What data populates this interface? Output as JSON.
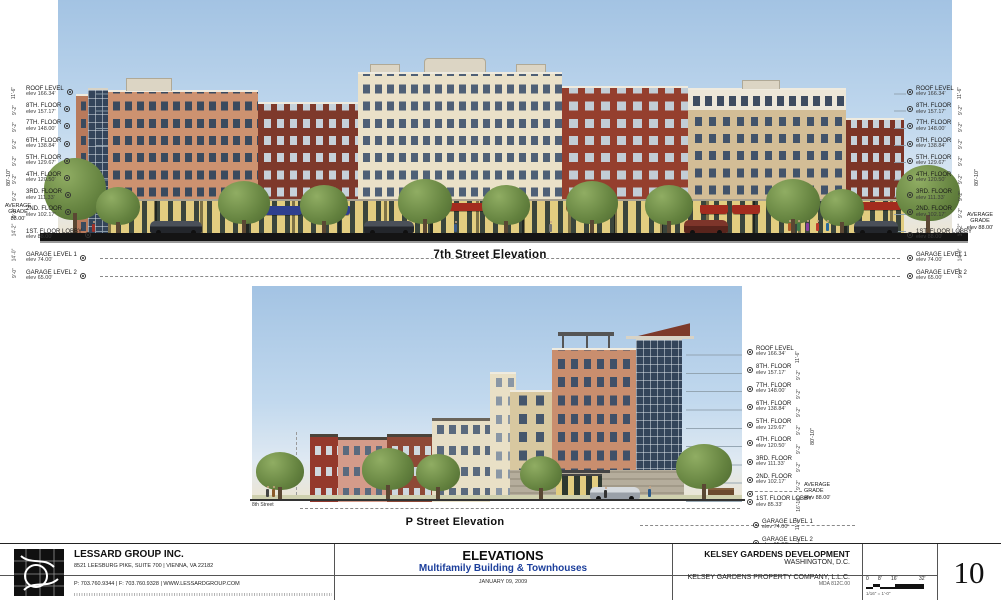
{
  "colors": {
    "subtitle_blue": "#1b3e9b",
    "awning_blue": "#2e3f8f",
    "awning_red": "#a32c1e",
    "sky_top": "#a3c3e3"
  },
  "elevation_7th": {
    "title": "7th Street  Elevation",
    "floors": [
      {
        "name": "ROOF LEVEL",
        "elev": "elev 166.34'"
      },
      {
        "name": "8TH. FLOOR",
        "elev": "elev 157.17'"
      },
      {
        "name": "7TH. FLOOR",
        "elev": "elev 148.00'"
      },
      {
        "name": "6TH. FLOOR",
        "elev": "elev 138.84'"
      },
      {
        "name": "5TH. FLOOR",
        "elev": "elev 129.67'"
      },
      {
        "name": "4TH. FLOOR",
        "elev": "elev 120.50'"
      },
      {
        "name": "3RD. FLOOR",
        "elev": "elev 111.33'"
      },
      {
        "name": "2ND. FLOOR",
        "elev": "elev 102.17'"
      },
      {
        "name": "1ST. FLOOR LOBBY",
        "elev": "elev 88.00'"
      }
    ],
    "garage_levels": [
      {
        "name": "GARAGE LEVEL 1",
        "elev": "elev 74.00'"
      },
      {
        "name": "GARAGE LEVEL 2",
        "elev": "elev 65.00'"
      }
    ],
    "floor_dims": [
      "11'-6\"",
      "9'-2\"",
      "9'-2\"",
      "9'-2\"",
      "9'-2\"",
      "9'-2\"",
      "9'-2\"",
      "9'-2\"",
      "14'-2\""
    ],
    "garage_dims": [
      "14'-0\"",
      "9'-0\""
    ],
    "overall_dim": "80'-10\"",
    "avg_grade_left": {
      "name": "AVERAGE GRADE",
      "elev": "88.00'"
    },
    "avg_grade_right": {
      "name": "AVERAGE GRADE",
      "elev": "elev 88.00'"
    }
  },
  "elevation_p": {
    "title": "P Street  Elevation",
    "street_label": "8th Street",
    "floors": [
      {
        "name": "ROOF LEVEL",
        "elev": "elev 166.34'"
      },
      {
        "name": "8TH. FLOOR",
        "elev": "elev 157.17'"
      },
      {
        "name": "7TH. FLOOR",
        "elev": "elev 148.00'"
      },
      {
        "name": "6TH. FLOOR",
        "elev": "elev 138.84'"
      },
      {
        "name": "5TH. FLOOR",
        "elev": "elev 129.67'"
      },
      {
        "name": "4TH. FLOOR",
        "elev": "elev 120.50'"
      },
      {
        "name": "3RD. FLOOR",
        "elev": "elev 111.33'"
      },
      {
        "name": "2ND. FLOOR",
        "elev": "elev 102.17'"
      },
      {
        "name": "1ST. FLOOR LOBBY",
        "elev": "elev 85.33'"
      }
    ],
    "garage_levels": [
      {
        "name": "GARAGE LEVEL 1",
        "elev": "elev 74.00'"
      },
      {
        "name": "GARAGE LEVEL 2",
        "elev": "elev 65.00'"
      }
    ],
    "floor_dims": [
      "11'-6\"",
      "9'-2\"",
      "9'-2\"",
      "9'-2\"",
      "9'-2\"",
      "9'-2\"",
      "9'-2\"",
      "9'-2\"",
      "16'-10\""
    ],
    "garage_dims": [
      "11'-4\"",
      "9'-0\""
    ],
    "overall_dim": "80'-10\"",
    "avg_grade": {
      "name": "AVERAGE GRADE",
      "elev": "elev 88.00'"
    }
  },
  "title_block": {
    "firm": {
      "name": "LESSARD GROUP INC.",
      "address": "8521 LEESBURG PIKE, SUITE 700 | VIENNA, VA 22182",
      "contact": "P: 703.760.9344 | F: 703.760.9328 | WWW.LESSARDGROUP.COM"
    },
    "project": {
      "title": "ELEVATIONS",
      "subtitle": "Multifamily Building & Townhouses",
      "date": "JANUARY 09, 2009"
    },
    "client": {
      "name": "KELSEY GARDENS DEVELOPMENT",
      "city": "WASHINGTON, D.C.",
      "owner": "KELSEY GARDENS PROPERTY COMPANY, L.L.C.",
      "project_no": "MDA 812C.00"
    },
    "scale_bar": {
      "ticks": [
        "0",
        "8'",
        "16'",
        "32'"
      ],
      "note": "1/16\" = 1'-0\""
    },
    "sheet_number": "10"
  }
}
